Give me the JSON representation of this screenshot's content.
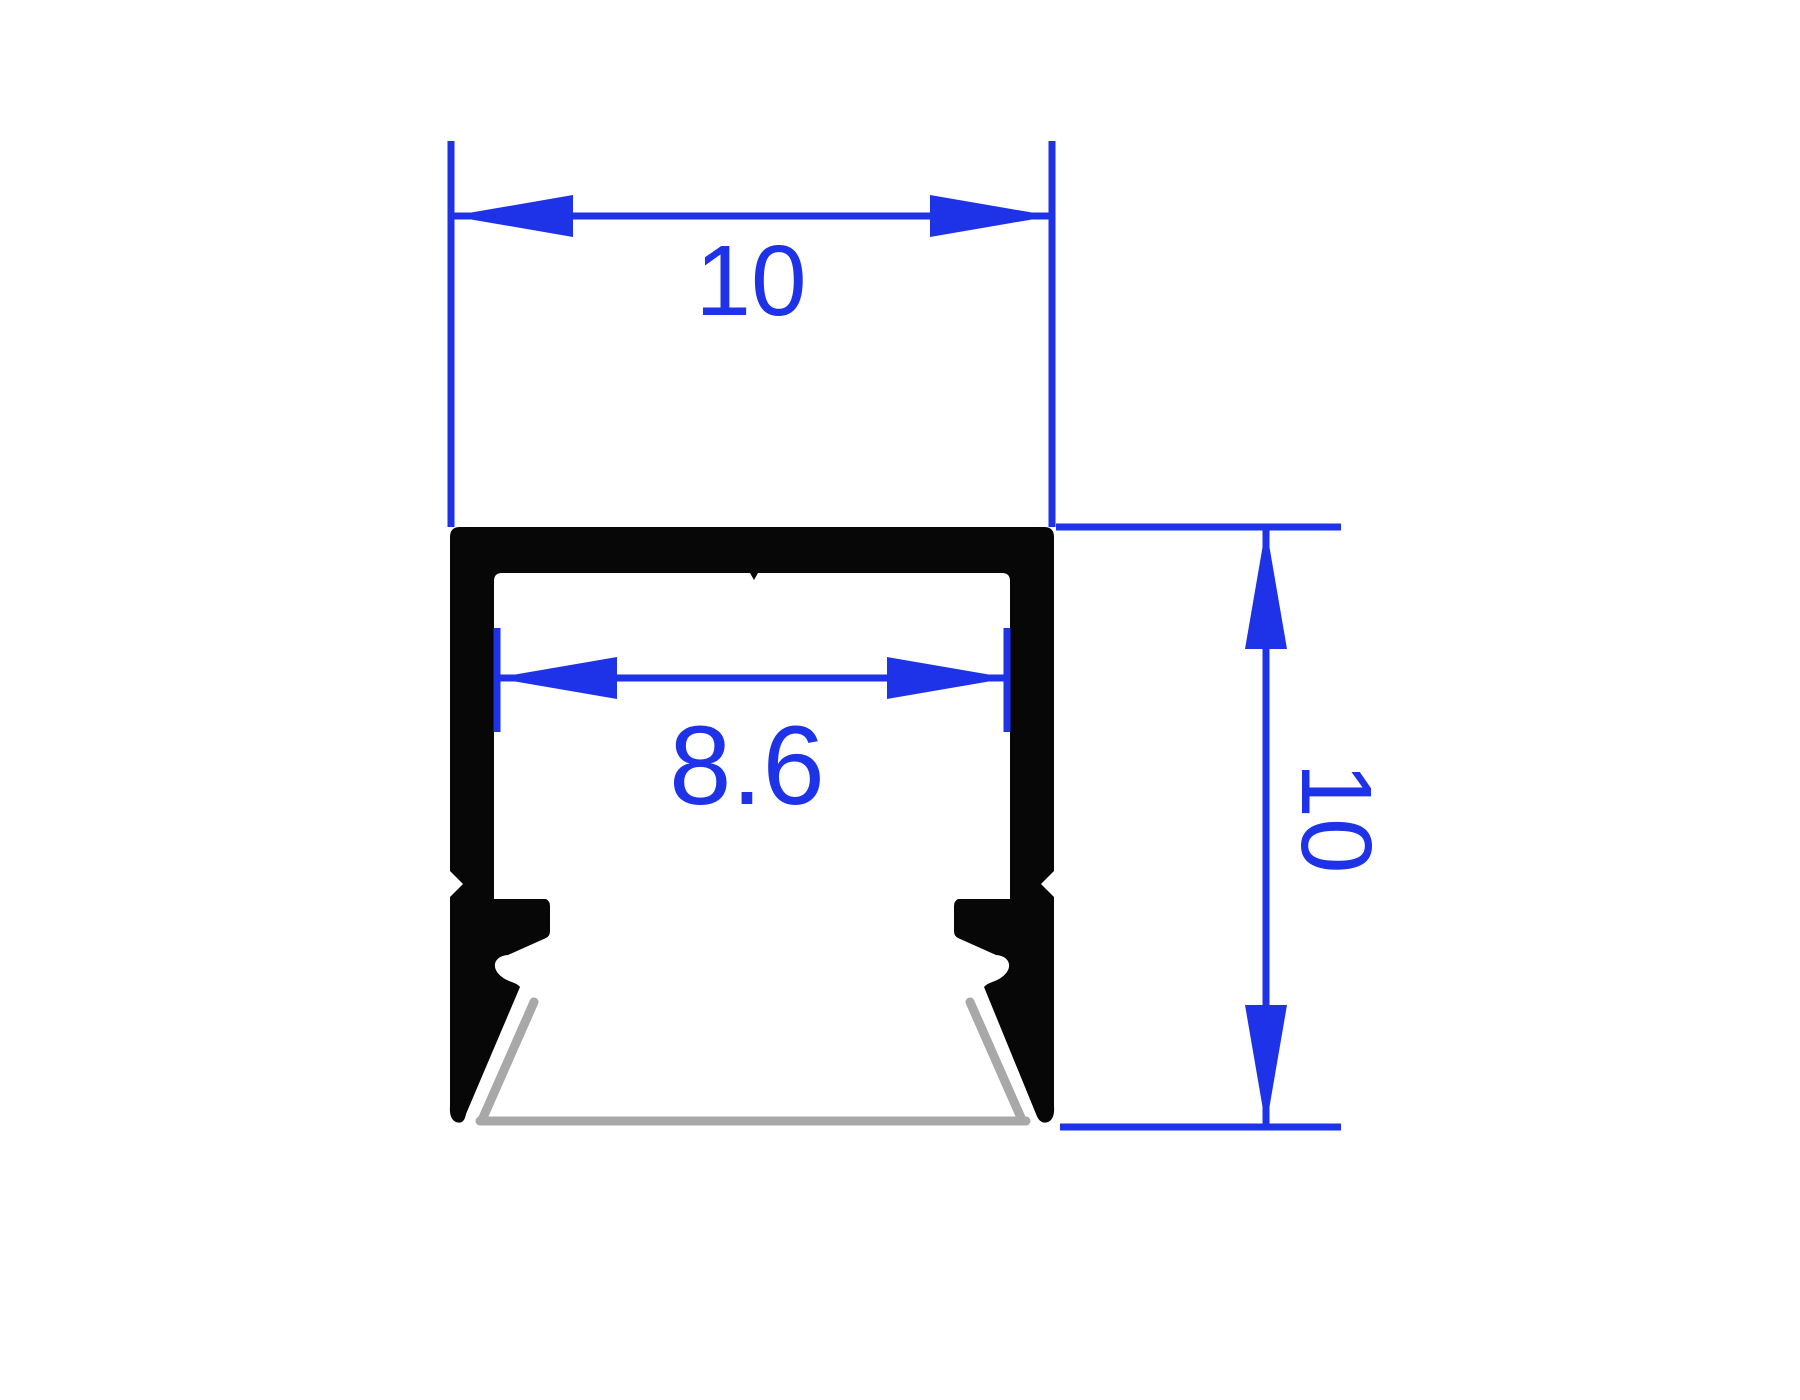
{
  "drawing": {
    "kind": "profile-cross-section-dimension-drawing",
    "colors": {
      "dimension_blue": "#1e32e8",
      "profile_black": "#070707",
      "shadow_gray": "#a8a8a8",
      "background": "#ffffff"
    },
    "dimensions": {
      "outer_width": {
        "label": "10",
        "value": 10
      },
      "inner_width": {
        "label": "8.6",
        "value": 8.6
      },
      "outer_height": {
        "label": "10",
        "value": 10
      }
    }
  }
}
